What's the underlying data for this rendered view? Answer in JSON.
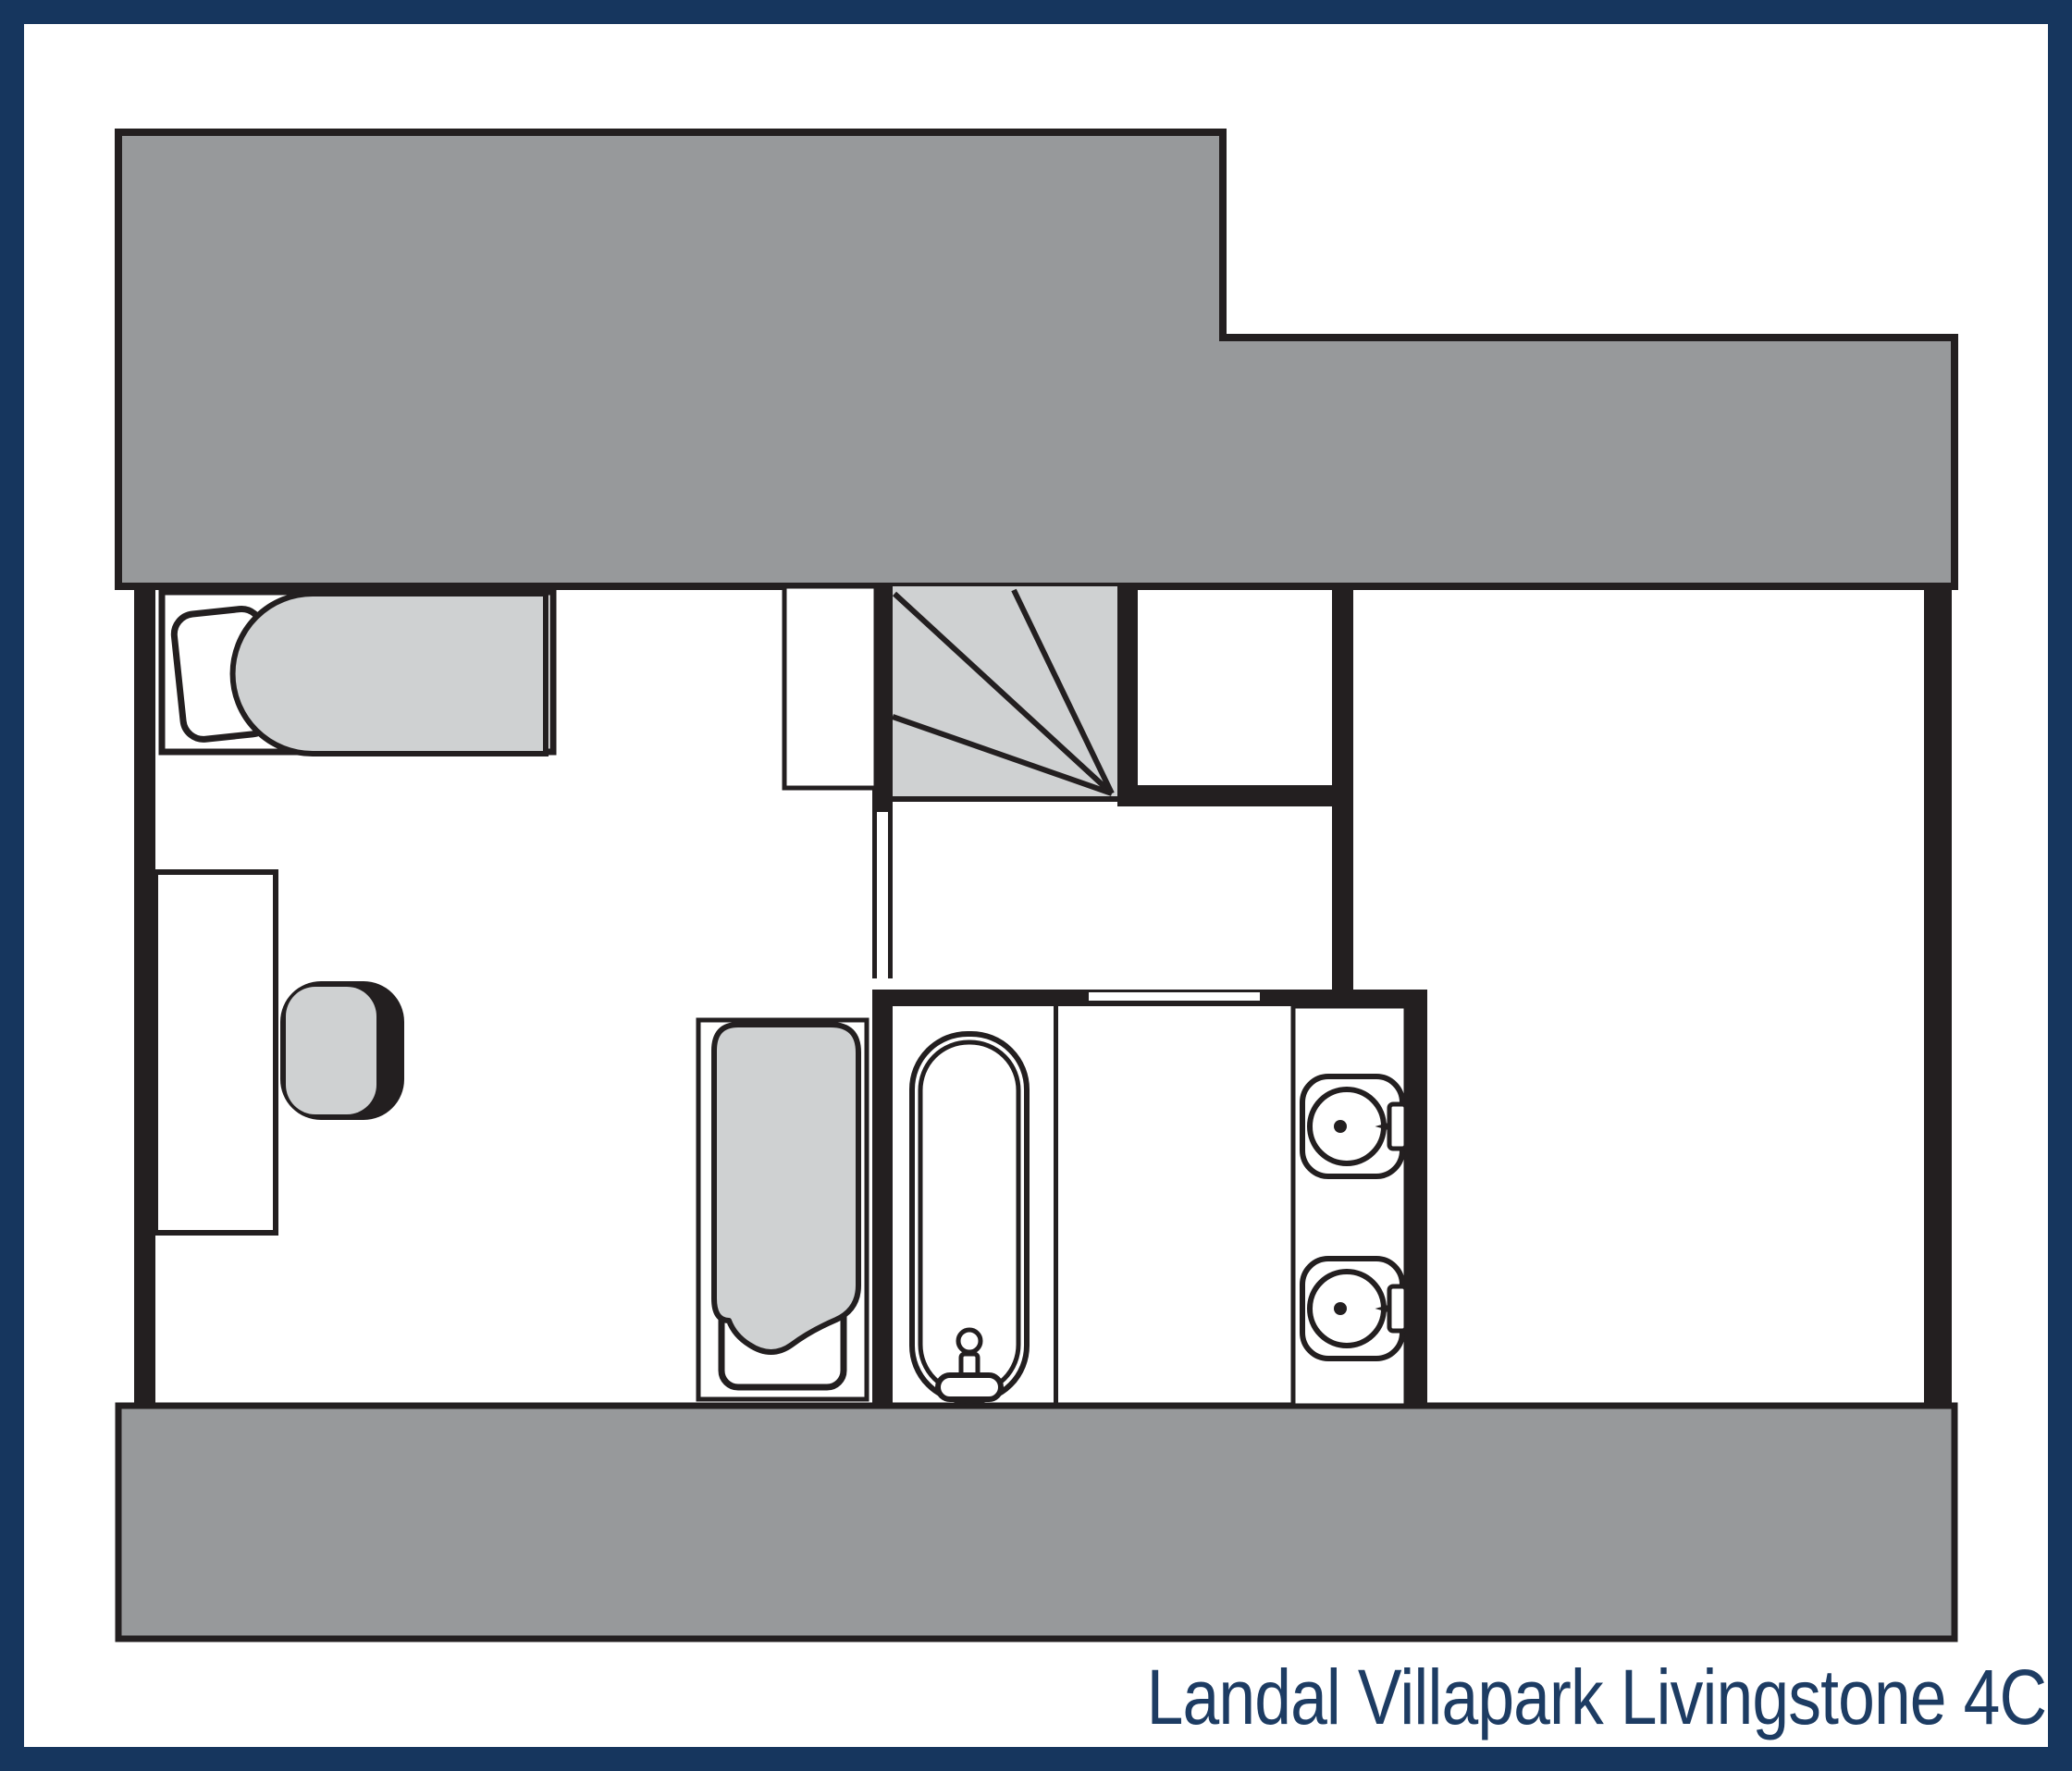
{
  "footer": {
    "title": "Landal Villapark Livingstone 4C"
  },
  "colors": {
    "border_navy": "#16365E",
    "title_navy": "#1D3C63",
    "roof_gray": "#97999B",
    "fixture_gray": "#CFD1D2",
    "wall_black": "#231F20",
    "floor_white": "#FFFFFF"
  }
}
